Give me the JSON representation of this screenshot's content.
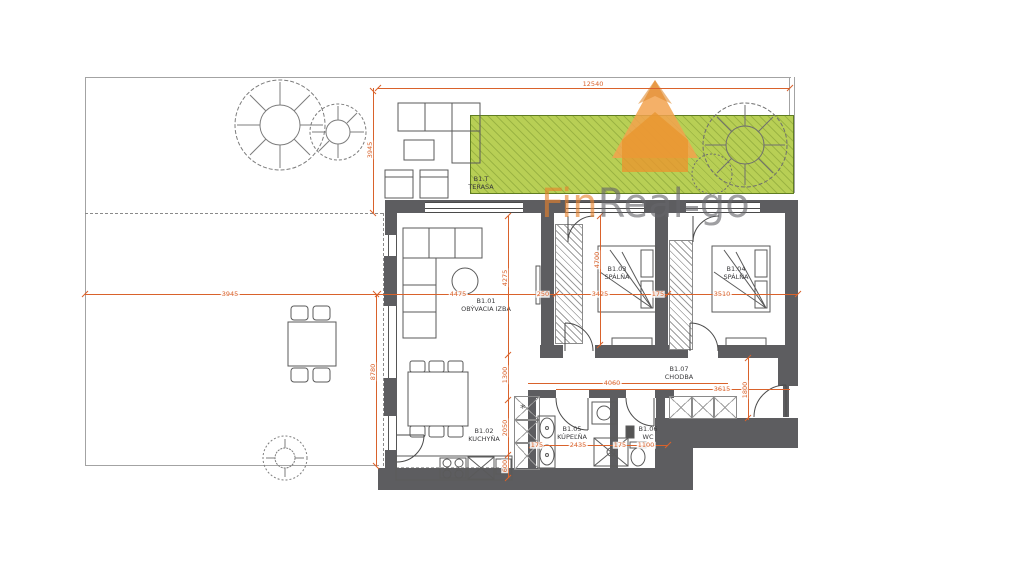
{
  "watermark": {
    "fin": "Fin",
    "real": "Real",
    "go": "go"
  },
  "rooms": [
    {
      "code": "B1.T",
      "name": "TERASA"
    },
    {
      "code": "B1.01",
      "name": "OBÝVACIA IZBA"
    },
    {
      "code": "B1.02",
      "name": "KUCHYŇA"
    },
    {
      "code": "B1.03",
      "name": "SPÁLŇA"
    },
    {
      "code": "B1.04",
      "name": "SPÁLŇA"
    },
    {
      "code": "B1.05",
      "name": "KÚPEĽŇA"
    },
    {
      "code": "B1.06",
      "name": "WC"
    },
    {
      "code": "B1.07",
      "name": "CHODBA"
    }
  ],
  "dims": {
    "total_width": "12540",
    "terrace_depth": "3945",
    "yard_width": "3945",
    "yard_depth": "8780",
    "living_width": "4475",
    "living_height": "4275",
    "wall_offset": "250",
    "bedroom1_width": "3425",
    "bedroom1_height": "4700",
    "bedrooms_gap": "175",
    "bedroom2_width": "3510",
    "kitchen_d1": "1300",
    "kitchen_d2": "2050",
    "kitchen_d3": "600",
    "bath_top_width": "4060",
    "hall_width": "3615",
    "hall_height": "1800",
    "bath_offset": "175",
    "bath_width": "2435",
    "wc_gap": "175",
    "wc_width": "1100"
  },
  "colors": {
    "dimension": "#D9622B",
    "lawn": "#B8CF55",
    "wall": "#5D5D60",
    "logo_orange": "#EFA24C",
    "watermark_gray": "#66666A"
  }
}
